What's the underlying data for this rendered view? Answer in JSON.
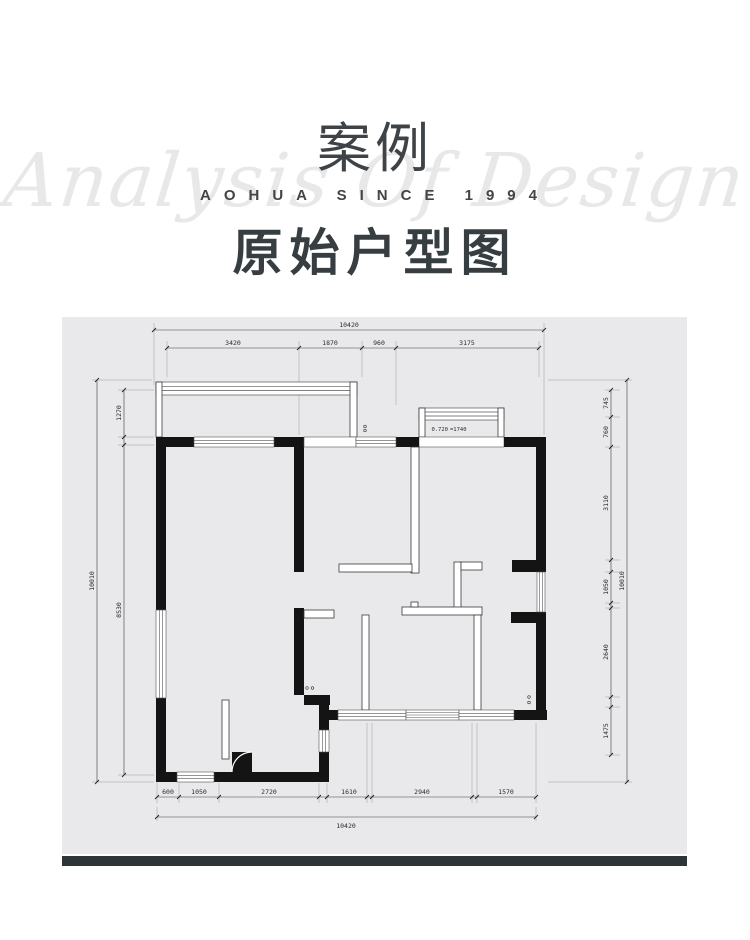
{
  "header": {
    "title": "案例",
    "watermark_script": "Analysis Of Design",
    "watermark_caps": "AOHUA SINCE 1994",
    "subtitle": "原始户型图"
  },
  "plan": {
    "bay_label_blue": "0.720",
    "bay_label_orange": "=1740",
    "dims": {
      "top_total": "10420",
      "top": [
        "3420",
        "1870",
        "960",
        "3175"
      ],
      "left_total": "10010",
      "left": [
        "1270",
        "8530"
      ],
      "right_total": "10010",
      "right": [
        "745",
        "760",
        "3110",
        "1050",
        "2640",
        "1475"
      ],
      "bottom_total": "10420",
      "bottom": [
        "600",
        "1050",
        "2720",
        "1610",
        "2940",
        "1570"
      ]
    }
  },
  "colors": {
    "card_bg": "#e9e9eb",
    "footer_bar": "#2e3539",
    "wall": "#141414",
    "bay_label_blue": "#4577b8",
    "bay_label_orange": "#c8823a",
    "title_text": "#3d4347",
    "watermark": "#e8e8e9"
  }
}
